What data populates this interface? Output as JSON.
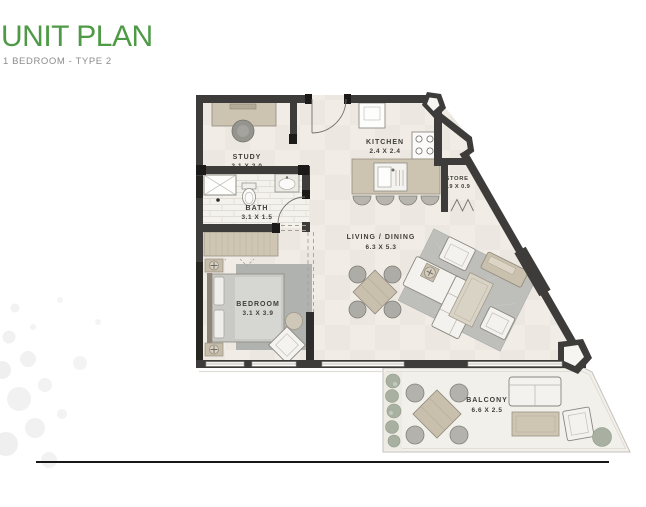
{
  "page": {
    "title": "UNIT PLAN",
    "subtitle": "1 BEDROOM - TYPE 2"
  },
  "colors": {
    "title_green": "#4f9a46",
    "subtitle_gray": "#8c8c8c",
    "wall_dark": "#3e3c3a",
    "floor_beige": "#f1ede6",
    "furniture_tan": "#cdc3b1",
    "rug_gray": "#bebeba",
    "plant_green": "#a8b0a1",
    "label_text": "#3f3d3a"
  },
  "rooms": [
    {
      "id": "study",
      "name": "STUDY",
      "dims": "3.1 X 2.0"
    },
    {
      "id": "kitchen",
      "name": "KITCHEN",
      "dims": "2.4 X 2.4"
    },
    {
      "id": "store",
      "name": "STORE",
      "dims": "0.9 X 0.9"
    },
    {
      "id": "bath",
      "name": "BATH",
      "dims": "3.1 X 1.5"
    },
    {
      "id": "living_dining",
      "name": "LIVING / DINING",
      "dims": "6.3 X 5.3"
    },
    {
      "id": "bedroom",
      "name": "BEDROOM",
      "dims": "3.1 X 3.9"
    },
    {
      "id": "balcony",
      "name": "BALCONY",
      "dims": "6.6 X 2.5"
    }
  ]
}
